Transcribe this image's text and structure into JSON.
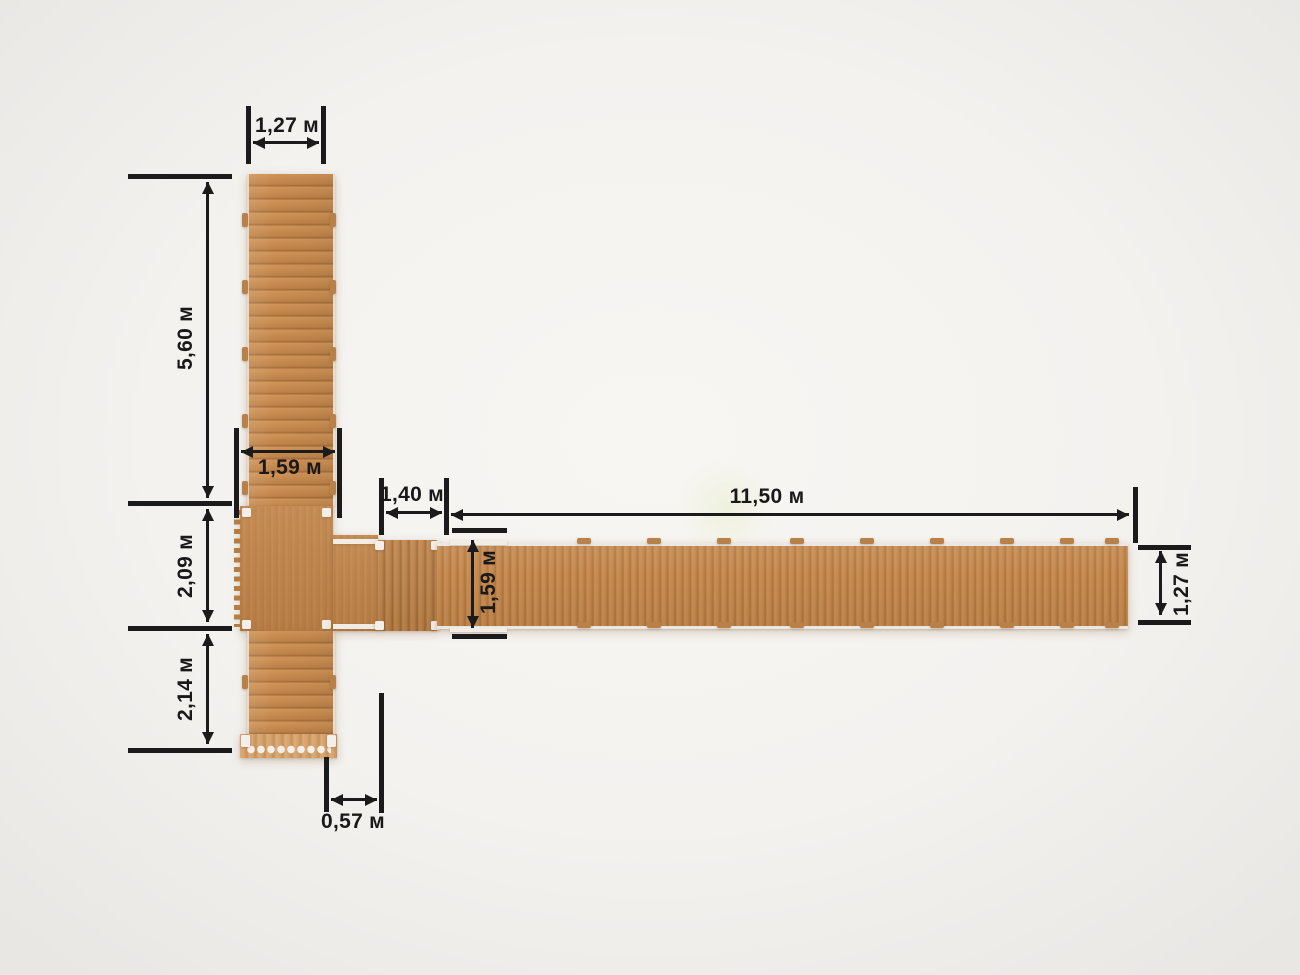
{
  "figure": {
    "description": "Top-view dimensioned plan of a T-shaped wooden walkway with central platform and ramp",
    "unit_suffix": "м"
  },
  "dims": {
    "top_width": "1,27 м",
    "left_upper_length": "5,60 м",
    "upper_walkway_width": "1,59 м",
    "platform_length": "2,09 м",
    "lower_walkway_length": "2,14 м",
    "bottom_offset": "0,57 м",
    "ramp_length": "1,40 м",
    "main_walkway_length": "11,50 м",
    "main_walkway_width": "1,59 м",
    "right_end_width": "1,27 м"
  },
  "colors": {
    "background": "#f4f2ef",
    "wood_base": "#c98c52",
    "wood_gap": "#a06a38",
    "wood_platform": "#c1844a",
    "wood_step_light": "#dcab77",
    "hardware_white": "#f4f0e9",
    "dimension_line": "#1b1b1b",
    "label_text": "#191919"
  }
}
